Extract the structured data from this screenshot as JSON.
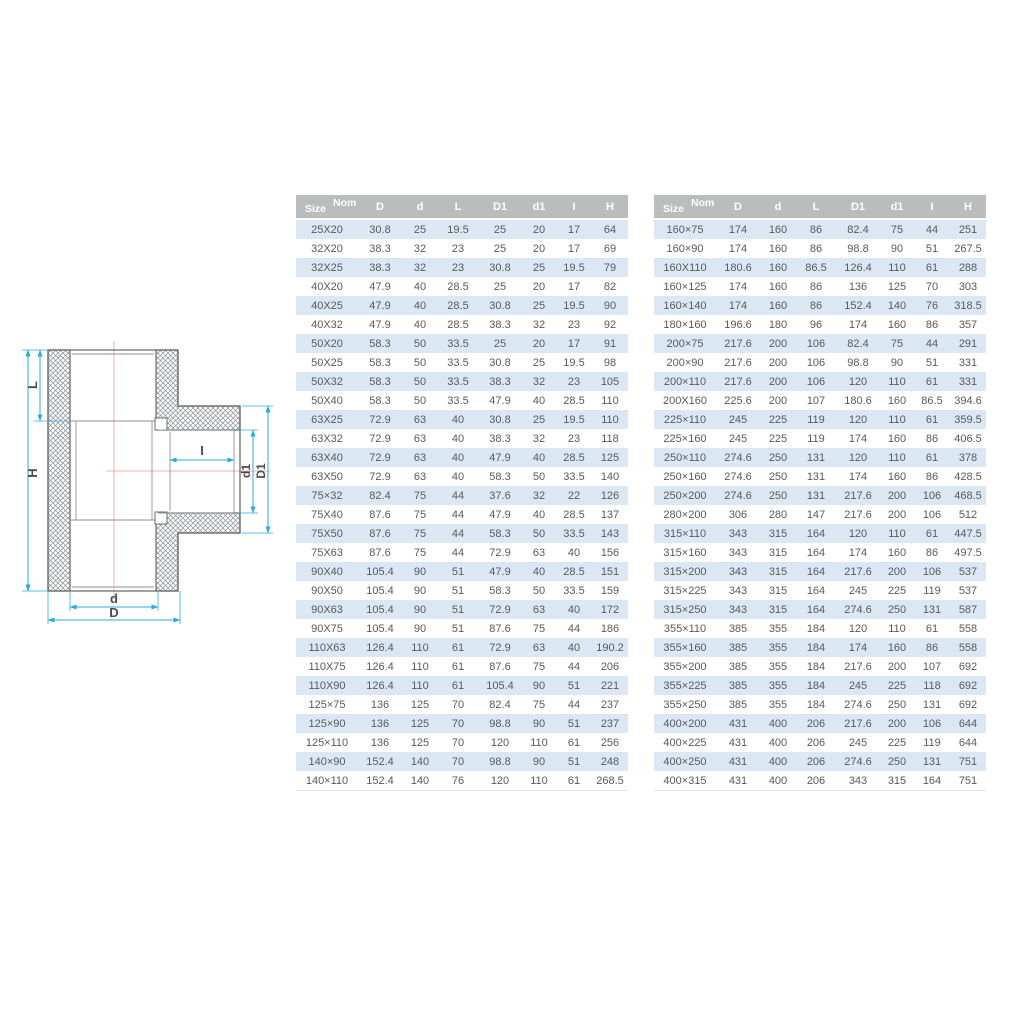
{
  "diagram": {
    "labels": {
      "L": "L",
      "H": "H",
      "I": "I",
      "d1": "d1",
      "D1": "D1",
      "d": "d",
      "D": "D"
    },
    "colors": {
      "dimension_line": "#29abe2",
      "centerline": "#f0b1ab",
      "outline": "#6a6c6e",
      "label_text": "#4a4b4d"
    }
  },
  "tables": [
    {
      "name": "small-sizes",
      "header": {
        "size_label": "Size",
        "nom_label": "Nom",
        "columns": [
          "D",
          "d",
          "L",
          "D1",
          "d1",
          "I",
          "H"
        ]
      },
      "rows": [
        [
          "25X20",
          "30.8",
          "25",
          "19.5",
          "25",
          "20",
          "17",
          "64"
        ],
        [
          "32X20",
          "38.3",
          "32",
          "23",
          "25",
          "20",
          "17",
          "69"
        ],
        [
          "32X25",
          "38.3",
          "32",
          "23",
          "30.8",
          "25",
          "19.5",
          "79"
        ],
        [
          "40X20",
          "47.9",
          "40",
          "28.5",
          "25",
          "20",
          "17",
          "82"
        ],
        [
          "40X25",
          "47.9",
          "40",
          "28.5",
          "30.8",
          "25",
          "19.5",
          "90"
        ],
        [
          "40X32",
          "47.9",
          "40",
          "28.5",
          "38.3",
          "32",
          "23",
          "92"
        ],
        [
          "50X20",
          "58.3",
          "50",
          "33.5",
          "25",
          "20",
          "17",
          "91"
        ],
        [
          "50X25",
          "58.3",
          "50",
          "33.5",
          "30.8",
          "25",
          "19.5",
          "98"
        ],
        [
          "50X32",
          "58.3",
          "50",
          "33.5",
          "38.3",
          "32",
          "23",
          "105"
        ],
        [
          "50X40",
          "58.3",
          "50",
          "33.5",
          "47.9",
          "40",
          "28.5",
          "110"
        ],
        [
          "63X25",
          "72.9",
          "63",
          "40",
          "30.8",
          "25",
          "19.5",
          "110"
        ],
        [
          "63X32",
          "72.9",
          "63",
          "40",
          "38.3",
          "32",
          "23",
          "118"
        ],
        [
          "63X40",
          "72.9",
          "63",
          "40",
          "47.9",
          "40",
          "28.5",
          "125"
        ],
        [
          "63X50",
          "72.9",
          "63",
          "40",
          "58.3",
          "50",
          "33.5",
          "140"
        ],
        [
          "75×32",
          "82.4",
          "75",
          "44",
          "37.6",
          "32",
          "22",
          "126"
        ],
        [
          "75X40",
          "87.6",
          "75",
          "44",
          "47.9",
          "40",
          "28.5",
          "137"
        ],
        [
          "75X50",
          "87.6",
          "75",
          "44",
          "58.3",
          "50",
          "33.5",
          "143"
        ],
        [
          "75X63",
          "87.6",
          "75",
          "44",
          "72.9",
          "63",
          "40",
          "156"
        ],
        [
          "90X40",
          "105.4",
          "90",
          "51",
          "47.9",
          "40",
          "28.5",
          "151"
        ],
        [
          "90X50",
          "105.4",
          "90",
          "51",
          "58.3",
          "50",
          "33.5",
          "159"
        ],
        [
          "90X63",
          "105.4",
          "90",
          "51",
          "72.9",
          "63",
          "40",
          "172"
        ],
        [
          "90X75",
          "105.4",
          "90",
          "51",
          "87.6",
          "75",
          "44",
          "186"
        ],
        [
          "110X63",
          "126.4",
          "110",
          "61",
          "72.9",
          "63",
          "40",
          "190.2"
        ],
        [
          "110X75",
          "126.4",
          "110",
          "61",
          "87.6",
          "75",
          "44",
          "206"
        ],
        [
          "110X90",
          "126.4",
          "110",
          "61",
          "105.4",
          "90",
          "51",
          "221"
        ],
        [
          "125×75",
          "136",
          "125",
          "70",
          "82.4",
          "75",
          "44",
          "237"
        ],
        [
          "125×90",
          "136",
          "125",
          "70",
          "98.8",
          "90",
          "51",
          "237"
        ],
        [
          "125×110",
          "136",
          "125",
          "70",
          "120",
          "110",
          "61",
          "256"
        ],
        [
          "140×90",
          "152.4",
          "140",
          "70",
          "98.8",
          "90",
          "51",
          "248"
        ],
        [
          "140×110",
          "152.4",
          "140",
          "76",
          "120",
          "110",
          "61",
          "268.5"
        ]
      ]
    },
    {
      "name": "large-sizes",
      "header": {
        "size_label": "Size",
        "nom_label": "Nom",
        "columns": [
          "D",
          "d",
          "L",
          "D1",
          "d1",
          "I",
          "H"
        ]
      },
      "rows": [
        [
          "160×75",
          "174",
          "160",
          "86",
          "82.4",
          "75",
          "44",
          "251"
        ],
        [
          "160×90",
          "174",
          "160",
          "86",
          "98.8",
          "90",
          "51",
          "267.5"
        ],
        [
          "160X110",
          "180.6",
          "160",
          "86.5",
          "126.4",
          "110",
          "61",
          "288"
        ],
        [
          "160×125",
          "174",
          "160",
          "86",
          "136",
          "125",
          "70",
          "303"
        ],
        [
          "160×140",
          "174",
          "160",
          "86",
          "152.4",
          "140",
          "76",
          "318.5"
        ],
        [
          "180×160",
          "196.6",
          "180",
          "96",
          "174",
          "160",
          "86",
          "357"
        ],
        [
          "200×75",
          "217.6",
          "200",
          "106",
          "82.4",
          "75",
          "44",
          "291"
        ],
        [
          "200×90",
          "217.6",
          "200",
          "106",
          "98.8",
          "90",
          "51",
          "331"
        ],
        [
          "200×110",
          "217.6",
          "200",
          "106",
          "120",
          "110",
          "61",
          "331"
        ],
        [
          "200X160",
          "225.6",
          "200",
          "107",
          "180.6",
          "160",
          "86.5",
          "394.6"
        ],
        [
          "225×110",
          "245",
          "225",
          "119",
          "120",
          "110",
          "61",
          "359.5"
        ],
        [
          "225×160",
          "245",
          "225",
          "119",
          "174",
          "160",
          "86",
          "406.5"
        ],
        [
          "250×110",
          "274.6",
          "250",
          "131",
          "120",
          "110",
          "61",
          "378"
        ],
        [
          "250×160",
          "274.6",
          "250",
          "131",
          "174",
          "160",
          "86",
          "428.5"
        ],
        [
          "250×200",
          "274.6",
          "250",
          "131",
          "217.6",
          "200",
          "106",
          "468.5"
        ],
        [
          "280×200",
          "306",
          "280",
          "147",
          "217.6",
          "200",
          "106",
          "512"
        ],
        [
          "315×110",
          "343",
          "315",
          "164",
          "120",
          "110",
          "61",
          "447.5"
        ],
        [
          "315×160",
          "343",
          "315",
          "164",
          "174",
          "160",
          "86",
          "497.5"
        ],
        [
          "315×200",
          "343",
          "315",
          "164",
          "217.6",
          "200",
          "106",
          "537"
        ],
        [
          "315×225",
          "343",
          "315",
          "164",
          "245",
          "225",
          "119",
          "537"
        ],
        [
          "315×250",
          "343",
          "315",
          "164",
          "274.6",
          "250",
          "131",
          "587"
        ],
        [
          "355×110",
          "385",
          "355",
          "184",
          "120",
          "110",
          "61",
          "558"
        ],
        [
          "355×160",
          "385",
          "355",
          "184",
          "174",
          "160",
          "86",
          "558"
        ],
        [
          "355×200",
          "385",
          "355",
          "184",
          "217.6",
          "200",
          "107",
          "692"
        ],
        [
          "355×225",
          "385",
          "355",
          "184",
          "245",
          "225",
          "118",
          "692"
        ],
        [
          "355×250",
          "385",
          "355",
          "184",
          "274.6",
          "250",
          "131",
          "692"
        ],
        [
          "400×200",
          "431",
          "400",
          "206",
          "217.6",
          "200",
          "106",
          "644"
        ],
        [
          "400×225",
          "431",
          "400",
          "206",
          "245",
          "225",
          "119",
          "644"
        ],
        [
          "400×250",
          "431",
          "400",
          "206",
          "274.6",
          "250",
          "131",
          "751"
        ],
        [
          "400×315",
          "431",
          "400",
          "206",
          "343",
          "315",
          "164",
          "751"
        ]
      ]
    }
  ]
}
